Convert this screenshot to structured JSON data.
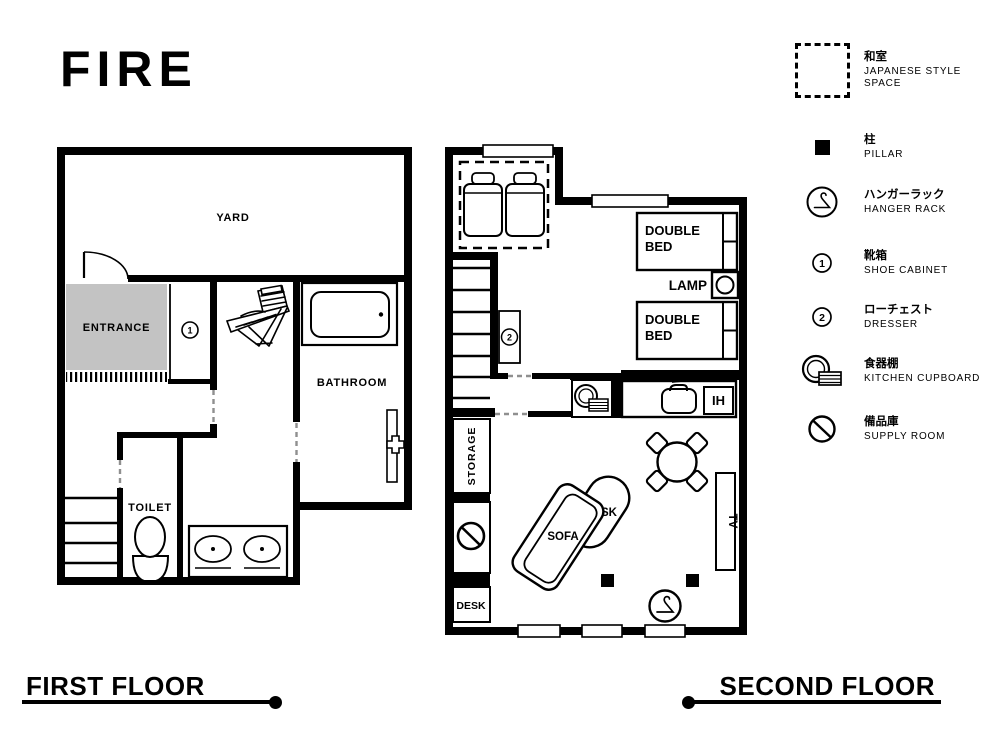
{
  "title": "FIRE",
  "colors": {
    "ink": "#000000",
    "paper": "#ffffff",
    "entrance_fill": "#c3c3c3"
  },
  "floor1": {
    "label": "FIRST FLOOR",
    "yard": "YARD",
    "entrance": "ENTRANCE",
    "toilet": "TOILET",
    "bathroom": "BATHROOM",
    "shoe_cabinet_number": "1"
  },
  "floor2": {
    "label": "SECOND FLOOR",
    "double_bed_word1": "DOUBLE",
    "double_bed_word2": "BED",
    "lamp": "LAMP",
    "ih": "IH",
    "storage": "STORAGE",
    "desk_closet": "DESK",
    "sofa": "SOFA",
    "desk": "DESK",
    "tv": "TV",
    "dresser_number": "2"
  },
  "legend": {
    "items": [
      {
        "icon": "japanese-style-space",
        "jp": "和室",
        "en": "JAPANESE STYLE SPACE"
      },
      {
        "icon": "pillar",
        "jp": "柱",
        "en": "PILLAR"
      },
      {
        "icon": "hanger-rack",
        "jp": "ハンガーラック",
        "en": "HANGER RACK"
      },
      {
        "icon": "shoe-cabinet",
        "number": "1",
        "jp": "靴箱",
        "en": "SHOE CABINET"
      },
      {
        "icon": "dresser",
        "number": "2",
        "jp": "ローチェスト",
        "en": "DRESSER"
      },
      {
        "icon": "kitchen-cupboard",
        "jp": "食器棚",
        "en": "KITCHEN CUPBOARD"
      },
      {
        "icon": "supply-room",
        "jp": "備品庫",
        "en": "SUPPLY ROOM"
      }
    ]
  }
}
